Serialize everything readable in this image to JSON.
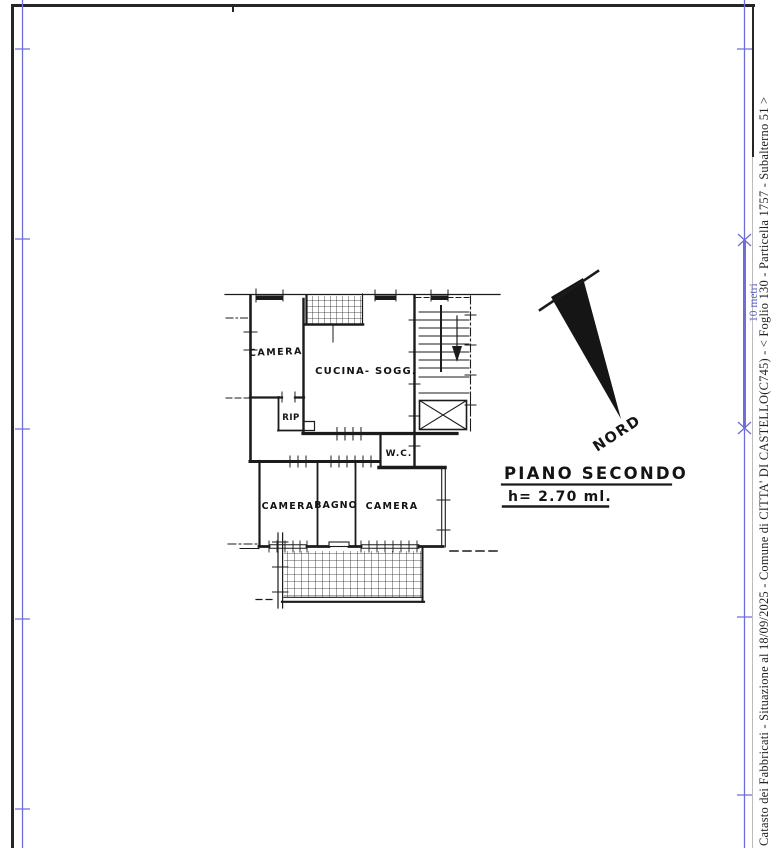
{
  "colors": {
    "paper": "#ffffff",
    "ink": "#1b1b1b",
    "frame": "#262626",
    "guide_blue": "#6e6ed8"
  },
  "margin_strip": {
    "info_text": "Catasto dei Fabbricati - Situazione al 18/09/2025 - Comune di CITTA' DI CASTELLO(C745) - < Foglio 130 - Particella 1757 - Subalterno 51 >",
    "scale_label": "10 metri"
  },
  "plan": {
    "floor_title": "PIANO SECONDO",
    "height_note": "h= 2.70 ml.",
    "north_label": "NORD",
    "rooms": {
      "camera_top": "CAMERA",
      "cucina_soggiorno": "CUCINA- SOGG.",
      "ripostiglio": "RIP",
      "wc": "W.C.",
      "camera_left": "CAMERA",
      "bagno": "BAGNO",
      "camera_right": "CAMERA"
    }
  }
}
